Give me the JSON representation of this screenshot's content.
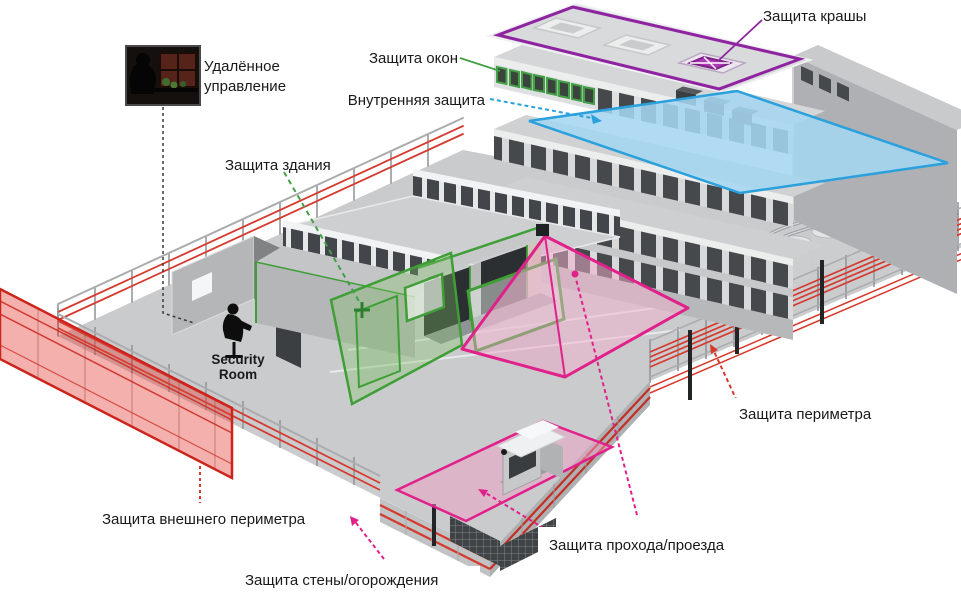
{
  "diagram": {
    "kind": "isometric-security-protection-overview",
    "background": "#ffffff"
  },
  "labels": {
    "roof": "Защита крашы",
    "windows": "Защита окон",
    "internal": "Внутренняя защита",
    "building": "Защита здания",
    "perimeter": "Защита периметра",
    "outer_perimeter": "Защита внешнего периметра",
    "passage": "Защита прохода/проезда",
    "wall_fence": "Защита стены/огорождения",
    "remote_line1": "Удалённое",
    "remote_line2": "управление",
    "security_room_line1": "Security",
    "security_room_line2": "Room"
  },
  "colors": {
    "roof_zone": "#8e24a0",
    "roof_skylight_fill": "#ad37b6",
    "window_zone": "#43a047",
    "building_zone": "#3f9f36",
    "internal_zone": "#2aa0dc",
    "internal_fill": "#a5d6f0",
    "perimeter_beams": "#d6392e",
    "outer_perimeter_fill": "#e3423a",
    "passage_zone": "#e0218a",
    "label_text": "#1a1a1a",
    "ground": "#c9cbcd",
    "building_window": "#46494c"
  },
  "icons": {
    "remote_photo": "operator-at-monitors-silhouette",
    "security_room": "guard-at-desk-silhouette"
  }
}
